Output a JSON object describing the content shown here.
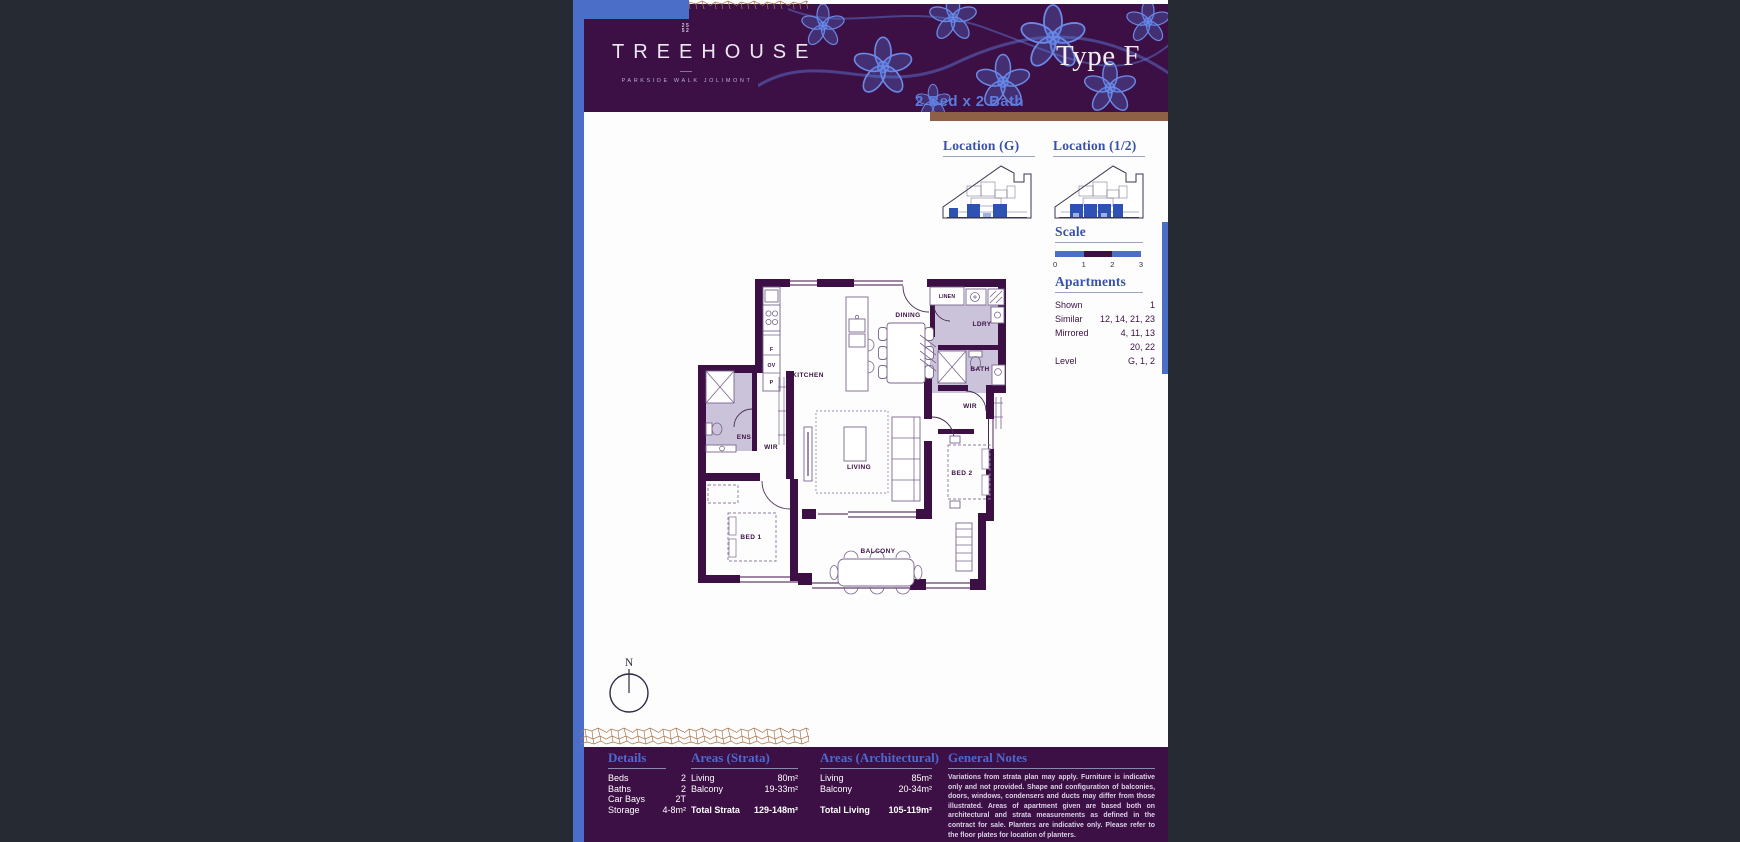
{
  "header": {
    "brand": "TREEHOUSE",
    "tagline": "PARKSIDE WALK JOLIMONT",
    "mark_line1": "25",
    "mark_line2": "52",
    "type_title": "Type F",
    "subtitle": "2 Bed x 2 Bath"
  },
  "sidebar": {
    "location_g_label": "Location (G)",
    "location_12_label": "Location (1/2)",
    "scale_label": "Scale",
    "scale_ticks": [
      "0",
      "1",
      "2",
      "3"
    ],
    "apartments_label": "Apartments",
    "apartments_rows": [
      {
        "label": "Shown",
        "value": "1"
      },
      {
        "label": "Similar",
        "value": "12, 14, 21, 23"
      },
      {
        "label": "Mirrored",
        "value": "4, 11, 13"
      },
      {
        "label": "",
        "value": "20, 22"
      },
      {
        "label": "Level",
        "value": "G, 1, 2"
      }
    ]
  },
  "floorplan": {
    "kitchen": "KITCHEN",
    "dining": "DINING",
    "living": "LIVING",
    "balcony": "BALCONY",
    "bed1": "BED 1",
    "bed2": "BED 2",
    "ens": "ENS",
    "wir_left": "WIR",
    "wir_right": "WIR",
    "bath": "BATH",
    "ldry": "LDRY",
    "linen": "LINEN",
    "fridge": "F",
    "oven": "OV",
    "pantry": "P",
    "north": "N"
  },
  "footer": {
    "details": {
      "heading": "Details",
      "rows": [
        {
          "label": "Beds",
          "value": "2"
        },
        {
          "label": "Baths",
          "value": "2"
        },
        {
          "label": "Car Bays",
          "value": "2T"
        },
        {
          "label": "Storage",
          "value": "4-8m²"
        }
      ]
    },
    "areas_strata": {
      "heading": "Areas (Strata)",
      "rows": [
        {
          "label": "Living",
          "value": "80m²"
        },
        {
          "label": "Balcony",
          "value": "19-33m²"
        }
      ],
      "total": {
        "label": "Total Strata",
        "value": "129-148m²"
      }
    },
    "areas_architectural": {
      "heading": "Areas (Architectural)",
      "rows": [
        {
          "label": "Living",
          "value": "85m²"
        },
        {
          "label": "Balcony",
          "value": "20-34m²"
        }
      ],
      "total": {
        "label": "Total Living",
        "value": "105-119m²"
      }
    },
    "general_notes": {
      "heading": "General Notes",
      "body": "Variations from strata plan may apply. Furniture is indicative only and not provided. Shape and configuration of balconies, doors, windows, condensers and ducts may differ from those illustrated. Areas of apartment given are based both on architectural and strata measurements as defined in the contract for sale. Planters are indicative only. Please refer to the floor plates for location of planters."
    }
  },
  "colors": {
    "background": "#262a32",
    "page": "#fdfdfd",
    "plum": "#3c1045",
    "accent_blue": "#4b6ec9",
    "heading_blue": "#3952a5",
    "footer_heading_blue": "#4b69cf",
    "brown": "#8e6046",
    "lavender": "#cbc3d9",
    "flower_blue": "#6c89e6"
  }
}
